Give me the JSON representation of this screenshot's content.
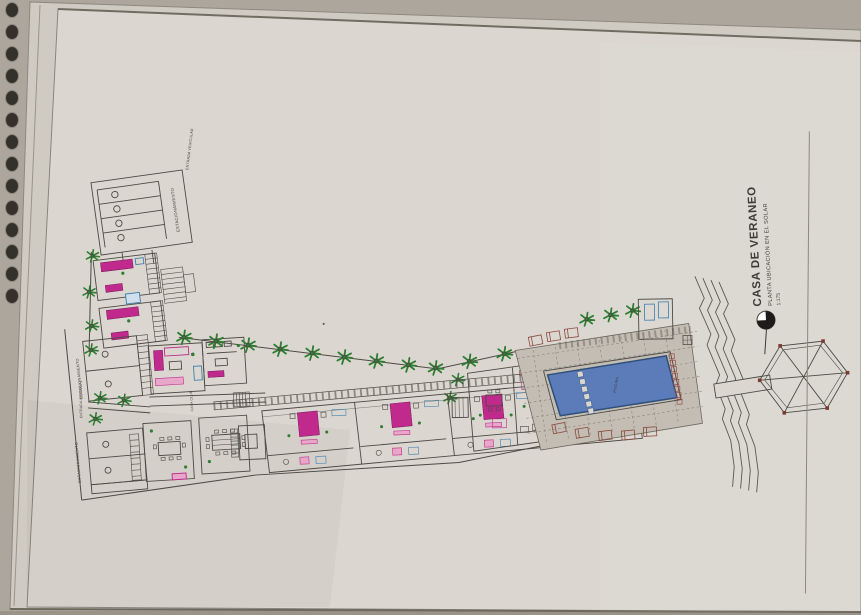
{
  "title_block": {
    "title": "CASA DE VERANEO",
    "subtitle": "PLANTA UBICACIÓN EN EL SOLAR",
    "scale": "1:175"
  },
  "labels": {
    "estacionamiento": "ESTACIONAMIENTO",
    "entrada_vehicular": "ENTRADA VEHICULAR",
    "entrada_peatonal": "ENTRADA PEATONAL",
    "casa_club": "CASA CLUB",
    "piscina": "PISCINA"
  },
  "colors": {
    "paper": "#dbd7d0",
    "ink": "#4b4a44",
    "furniture_magenta": "#bf2a8c",
    "wall_blue": "#3f7fae",
    "vegetation_green": "#2e7d32",
    "pool_water": "#5b7cb8",
    "lattice_red": "#9a4a44",
    "deck_gray": "#c3bdb4"
  }
}
